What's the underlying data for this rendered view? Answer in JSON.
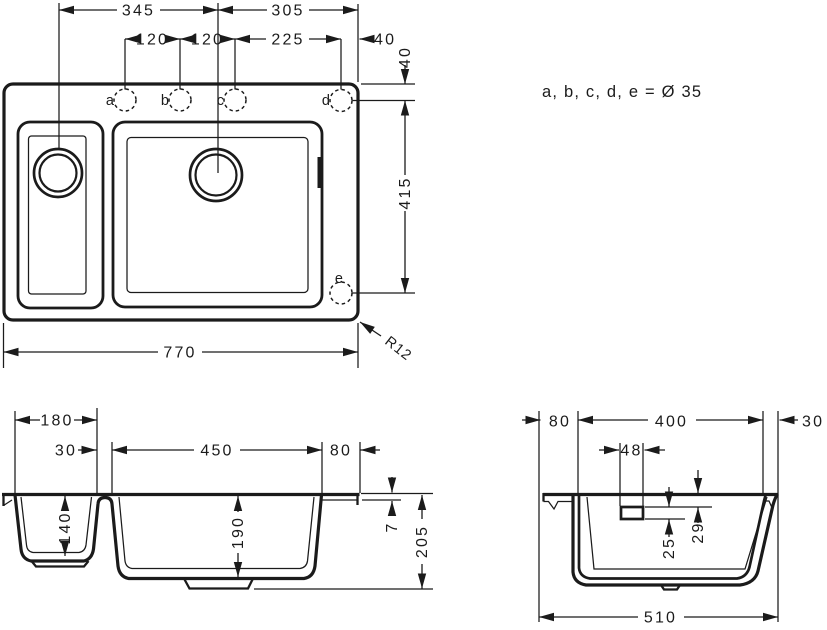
{
  "note": "a, b, c, d, e = Ø 35",
  "colors": {
    "line": "#1b1b1b",
    "background": "#ffffff"
  },
  "top_view": {
    "holes": {
      "a": "a",
      "b": "b",
      "c": "c",
      "d": "d",
      "e": "e"
    },
    "dims": {
      "d345": "345",
      "d305": "305",
      "d120a": "120",
      "d120b": "120",
      "d225": "225",
      "d40h": "40",
      "d40v": "40",
      "d415": "415",
      "d770": "770",
      "r12": "R12"
    }
  },
  "front_view": {
    "dims": {
      "d180": "180",
      "d30": "30",
      "d450": "450",
      "d80": "80",
      "d140": "140",
      "d190": "190",
      "d7": "7",
      "d205": "205"
    }
  },
  "side_view": {
    "dims": {
      "d80": "80",
      "d400": "400",
      "d30": "30",
      "d48": "48",
      "d25": "25",
      "d29": "29",
      "d510": "510"
    }
  }
}
